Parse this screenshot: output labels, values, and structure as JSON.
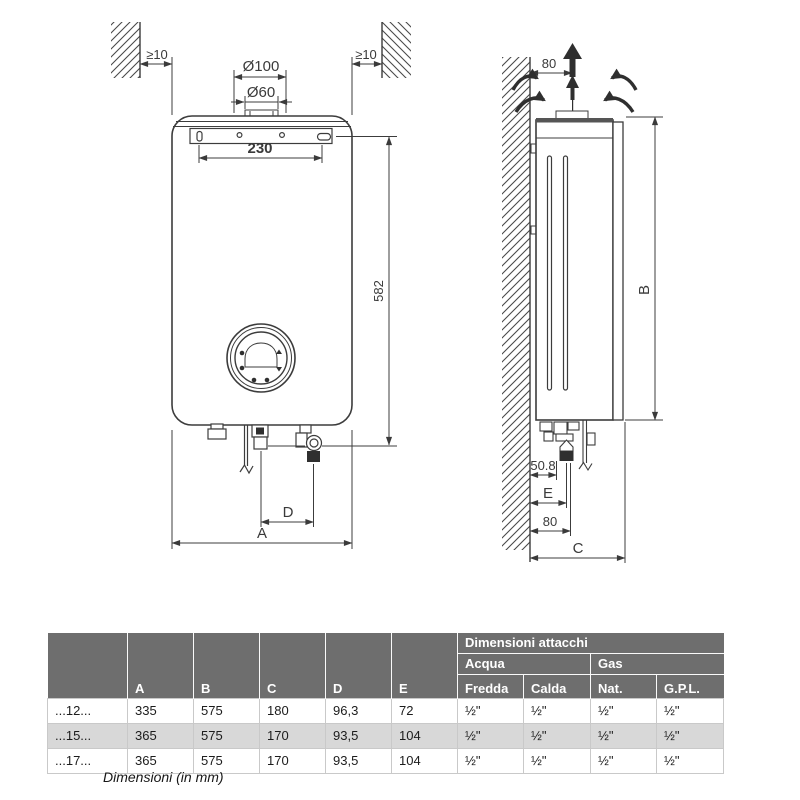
{
  "colors": {
    "line": "#3c3c3c",
    "fill_dark": "#2f2f2f",
    "table_header_bg": "#6e6e6e",
    "table_alt_row_bg": "#d8d8d8",
    "table_border": "#c9c9c9"
  },
  "front_view": {
    "clearance_left": "≥10",
    "clearance_right": "≥10",
    "flue_outer_diameter": "Ø100",
    "flue_inner_diameter": "Ø60",
    "bracket_hole_spacing": "230",
    "mount_height": "582",
    "width_label": "A",
    "connection_spacing_label": "D"
  },
  "side_view": {
    "flue_wall_offset": "80",
    "height_label": "B",
    "depth_label": "C",
    "drain_offset": "50.8",
    "connection_offset_label": "E",
    "gas_offset": "80"
  },
  "table": {
    "group_header": "Dimensioni attacchi",
    "water_header": "Acqua",
    "gas_header": "Gas",
    "col_letters": [
      "A",
      "B",
      "C",
      "D",
      "E"
    ],
    "conn_cols": [
      "Fredda",
      "Calda",
      "Nat.",
      "G.P.L."
    ],
    "rows": [
      [
        "...12...",
        "335",
        "575",
        "180",
        "96,3",
        "72",
        "½\"",
        "½\"",
        "½\"",
        "½\""
      ],
      [
        "...15...",
        "365",
        "575",
        "170",
        "93,5",
        "104",
        "½\"",
        "½\"",
        "½\"",
        "½\""
      ],
      [
        "...17...",
        "365",
        "575",
        "170",
        "93,5",
        "104",
        "½\"",
        "½\"",
        "½\"",
        "½\""
      ]
    ],
    "caption": "Dimensioni (in mm)"
  }
}
